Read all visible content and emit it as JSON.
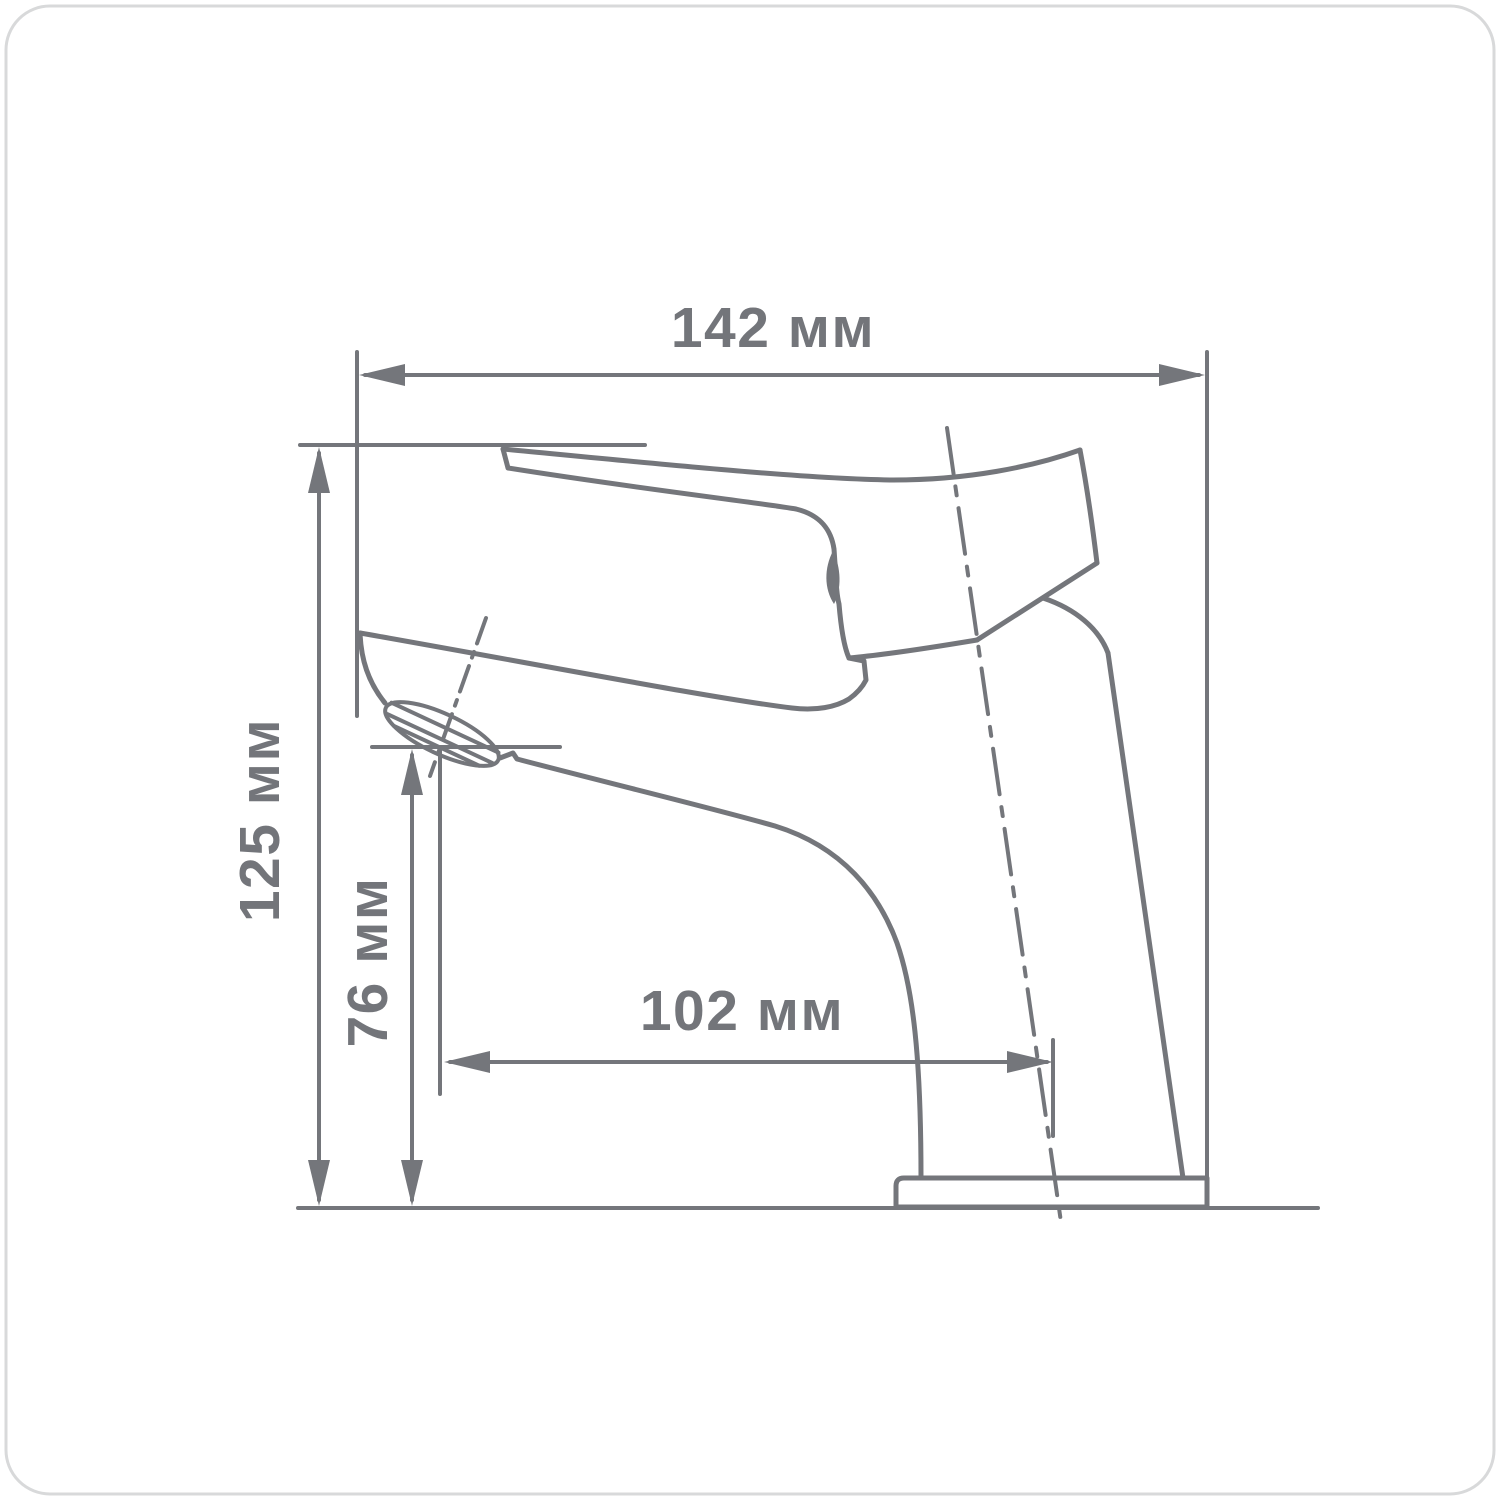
{
  "drawing": {
    "type": "technical dimension drawing",
    "subject": "single-lever basin mixer faucet, side view",
    "unit_suffix": "мм",
    "dimensions": {
      "overall_width": {
        "value": "142",
        "label": "142 мм"
      },
      "overall_height": {
        "value": "125",
        "label": "125 мм"
      },
      "spout_outlet_height": {
        "value": "76",
        "label": "76 мм"
      },
      "spout_reach": {
        "value": "102",
        "label": "102 мм"
      }
    },
    "colors": {
      "line": "#74767b",
      "text": "#73757a",
      "card_border": "#d8d9da",
      "background": "#ffffff"
    }
  }
}
